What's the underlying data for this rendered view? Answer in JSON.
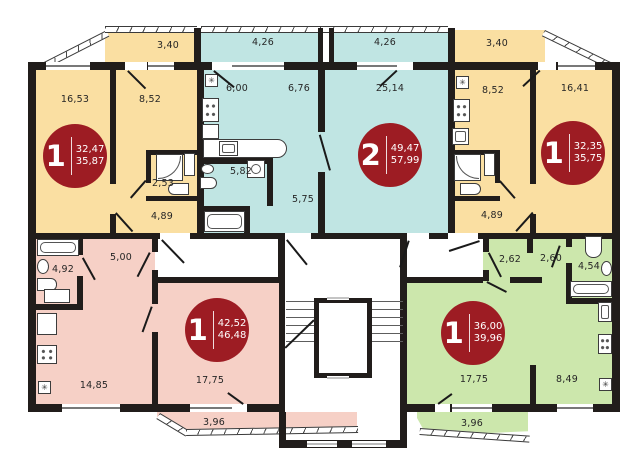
{
  "icons": {
    "vent": "✳"
  },
  "colors": {
    "wall": "#211d1b",
    "yellow": "#fadfa2",
    "teal": "#c0e5e3",
    "pink": "#f6d0c6",
    "green": "#cce7ac",
    "badge": "#9d1c23"
  },
  "apartments": [
    {
      "unit": "top-left",
      "badge": {
        "rooms": "1",
        "living_area": "32,47",
        "total_area": "35,87"
      },
      "rooms": [
        {
          "name": "living-room",
          "label": "16,53"
        },
        {
          "name": "kitchen",
          "label": "8,52"
        },
        {
          "name": "bathroom",
          "label": "2,53"
        },
        {
          "name": "hallway",
          "label": "4,89"
        },
        {
          "name": "balcony",
          "label": "3,40"
        }
      ]
    },
    {
      "unit": "top-center",
      "badge": {
        "rooms": "2",
        "living_area": "49,47",
        "total_area": "57,99"
      },
      "rooms": [
        {
          "name": "kitchen",
          "label": "6,00"
        },
        {
          "name": "dining",
          "label": "6,76"
        },
        {
          "name": "living-room",
          "label": "25,14"
        },
        {
          "name": "bathroom",
          "label": "5,82"
        },
        {
          "name": "hallway",
          "label": "5,75"
        },
        {
          "name": "balcony-left",
          "label": "4,26"
        },
        {
          "name": "balcony-right",
          "label": "4,26"
        }
      ]
    },
    {
      "unit": "top-right",
      "badge": {
        "rooms": "1",
        "living_area": "32,35",
        "total_area": "35,75"
      },
      "rooms": [
        {
          "name": "kitchen",
          "label": "8,52"
        },
        {
          "name": "living-room",
          "label": "16,41"
        },
        {
          "name": "hallway",
          "label": "4,89"
        },
        {
          "name": "balcony",
          "label": "3,40"
        }
      ]
    },
    {
      "unit": "bottom-left",
      "badge": {
        "rooms": "1",
        "living_area": "42,52",
        "total_area": "46,48"
      },
      "rooms": [
        {
          "name": "bathroom",
          "label": "4,92"
        },
        {
          "name": "hallway",
          "label": "5,00"
        },
        {
          "name": "kitchen-living",
          "label": "14,85"
        },
        {
          "name": "living-room",
          "label": "17,75"
        },
        {
          "name": "balcony",
          "label": "3,96"
        }
      ]
    },
    {
      "unit": "bottom-right",
      "badge": {
        "rooms": "1",
        "living_area": "36,00",
        "total_area": "39,96"
      },
      "rooms": [
        {
          "name": "hallway",
          "label": "2,62"
        },
        {
          "name": "hallway-2",
          "label": "2,60"
        },
        {
          "name": "bathroom",
          "label": "4,54"
        },
        {
          "name": "living-room",
          "label": "17,75"
        },
        {
          "name": "kitchen",
          "label": "8,49"
        },
        {
          "name": "balcony",
          "label": "3,96"
        }
      ]
    }
  ]
}
